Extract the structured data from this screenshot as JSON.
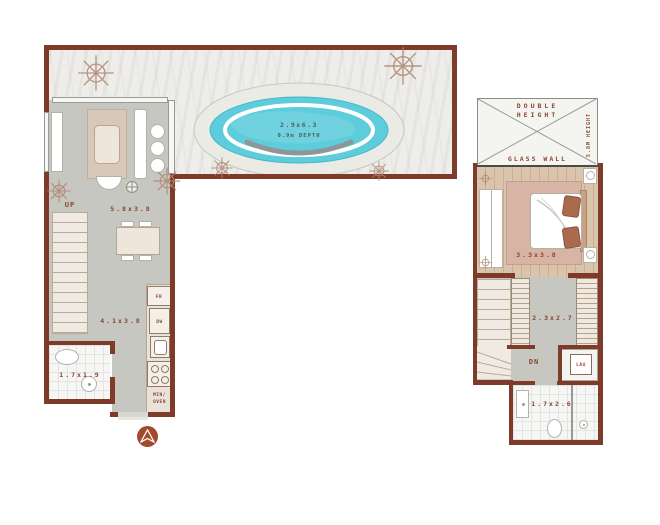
{
  "left_plan": {
    "pool": {
      "size": "2.9x6.3",
      "depth": "0.9m DEPTH"
    },
    "living": {
      "up": "UP",
      "size": "5.8x3.8"
    },
    "kitchen": {
      "size": "4.1x3.8",
      "fridge": "FR",
      "dishwasher": "DW",
      "oven_line1": "MIN/",
      "oven_line2": "OVEN"
    },
    "bathroom": {
      "size": "1.7x1.9"
    }
  },
  "right_plan": {
    "void": {
      "line1": "DOUBLE",
      "line2": "HEIGHT",
      "side_note": "5.8M HEIGHT",
      "glass": "GLASS WALL"
    },
    "bedroom": {
      "size": "3.3x3.8"
    },
    "dressing": {
      "size": "2.3x2.7",
      "down": "DN",
      "laundry": "LAU"
    },
    "bathroom": {
      "size": "1.7x2.6"
    }
  },
  "colors": {
    "wall": "#7e3b2a",
    "label_text": "#8a4434",
    "pool_water": "#5dccdb",
    "pool_deck": "#ebebe6",
    "terrace_floor": "#eeede9",
    "interior_floor": "#c5c7c0",
    "wood_floor": "#dac4ac",
    "bedroom_rug": "#d7b4a4",
    "bathroom_tile": "#f6f7f5",
    "kitchen_counter": "#eae2d6",
    "compass": "#a2492e",
    "tree": "#b08672"
  },
  "icons": {
    "compass": "north-arrow",
    "trees": "plan-trees",
    "fan": "ceiling-fan"
  }
}
